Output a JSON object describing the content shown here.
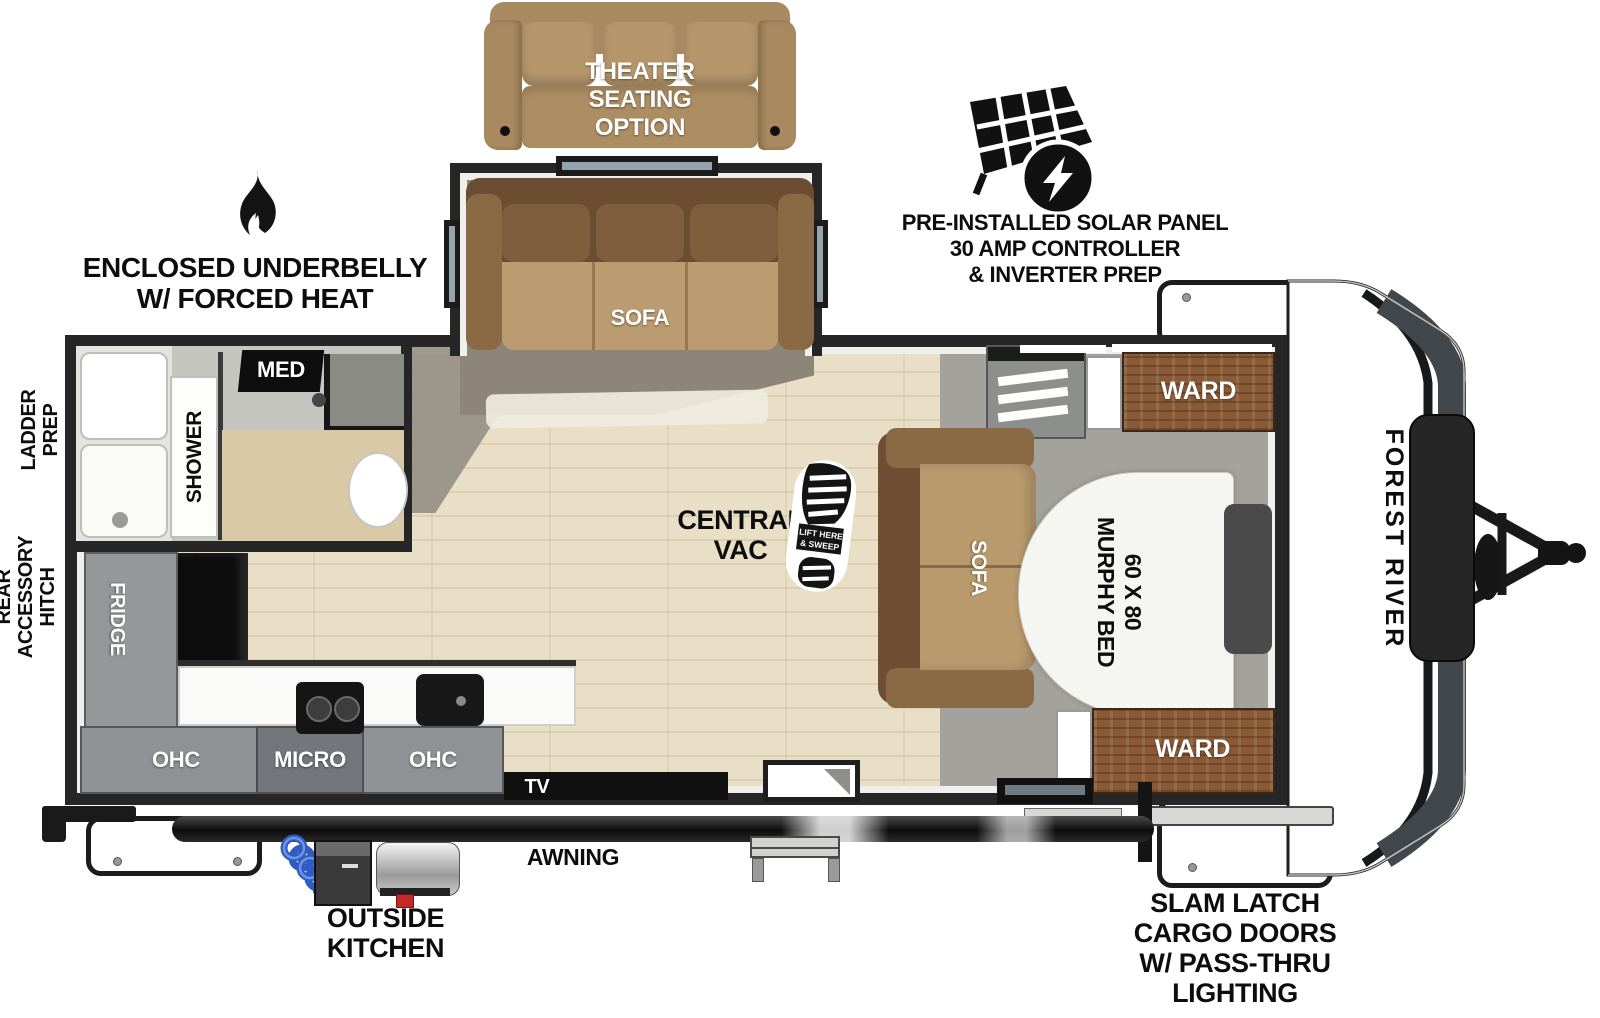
{
  "brand": "FOREST RIVER",
  "callouts": {
    "solar": [
      "PRE-INSTALLED SOLAR PANEL",
      "30 AMP CONTROLLER",
      "& INVERTER PREP"
    ],
    "underbelly": [
      "ENCLOSED UNDERBELLY",
      "W/ FORCED HEAT"
    ],
    "ladder_prep": [
      "LADDER",
      "PREP"
    ],
    "rear_hitch": [
      "REAR",
      "ACCESSORY",
      "HITCH"
    ],
    "cargo": [
      "SLAM LATCH",
      "CARGO DOORS",
      "W/ PASS-THRU",
      "LIGHTING"
    ],
    "outside_kitchen": [
      "OUTSIDE",
      "KITCHEN"
    ],
    "awning": "AWNING",
    "theater": [
      "THEATER",
      "SEATING",
      "OPTION"
    ]
  },
  "interior": {
    "slide_sofa": "SOFA",
    "shower": "SHOWER",
    "med": "MED",
    "central_vac": [
      "CENTRAL",
      "VAC"
    ],
    "boot": [
      "LIFT HERE",
      "& SWEEP"
    ],
    "ward_top": "WARD",
    "ward_bottom": "WARD",
    "bed_sofa": "SOFA",
    "murphy": [
      "60 X 80",
      "MURPHY BED"
    ],
    "fridge": "FRIDGE",
    "ohc_left": "OHC",
    "micro": "MICRO",
    "ohc_right": "OHC",
    "tv": "TV"
  },
  "colors": {
    "wall": "#262626",
    "floor_wood": "#e9dfc6",
    "sofa_tan": "#b5966b",
    "sofa_dark": "#6b4d32",
    "ward_wood": "#8a5a36",
    "bedroom_gray": "#a3a29c",
    "cabinet_gray": "#8f9194",
    "bed_white": "#f5f5f2",
    "hose_blue": "#3a6bd6"
  }
}
